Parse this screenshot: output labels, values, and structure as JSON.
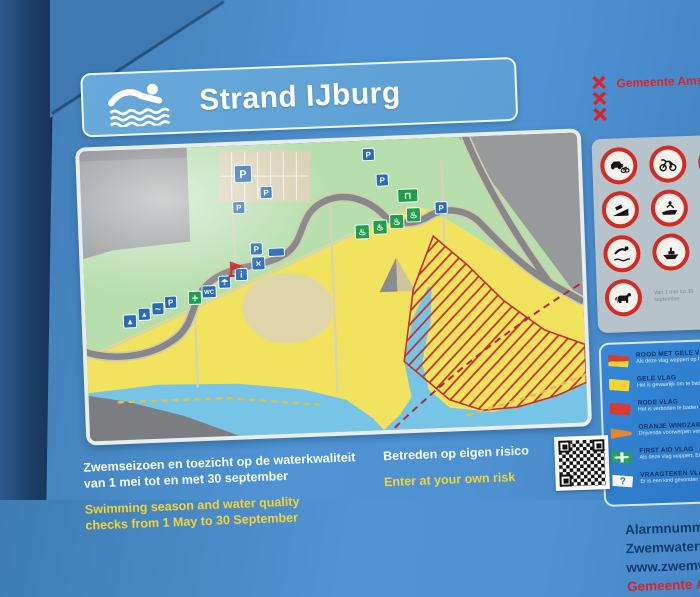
{
  "sign": {
    "title": "Strand IJburg"
  },
  "map": {
    "colors": {
      "park": "#b7dfae",
      "sand": "#f1e35e",
      "water": "#76c5e6",
      "road": "#85878b",
      "map_bg": "#97999a",
      "icon_blue": "#2b6cb8",
      "icon_green": "#1f9e4b",
      "hatch_red": "#c53030",
      "marker_red": "#cc2222"
    },
    "icons": [
      {
        "name": "parking",
        "glyph": "P",
        "x": 155,
        "y": 20,
        "w": 17,
        "h": 17,
        "fs": 11
      },
      {
        "name": "parking",
        "glyph": "P",
        "x": 284,
        "y": 8,
        "w": 12,
        "h": 12,
        "fs": 8
      },
      {
        "name": "parking",
        "glyph": "P",
        "x": 297,
        "y": 34,
        "w": 12,
        "h": 12,
        "fs": 8
      },
      {
        "name": "parking",
        "glyph": "P",
        "x": 180,
        "y": 42,
        "w": 12,
        "h": 12,
        "fs": 8
      },
      {
        "name": "parking",
        "glyph": "P",
        "x": 152,
        "y": 56,
        "w": 12,
        "h": 12,
        "fs": 8
      },
      {
        "name": "parking",
        "glyph": "P",
        "x": 168,
        "y": 98,
        "w": 12,
        "h": 12,
        "fs": 8
      },
      {
        "name": "parking",
        "glyph": "P",
        "x": 355,
        "y": 64,
        "w": 12,
        "h": 12,
        "fs": 8
      },
      {
        "name": "parking",
        "glyph": "P",
        "x": 80,
        "y": 148,
        "w": 12,
        "h": 12,
        "fs": 8
      },
      {
        "name": "wc",
        "glyph": "WC",
        "x": 118,
        "y": 139,
        "w": 14,
        "h": 12,
        "fs": 6
      },
      {
        "name": "shower",
        "glyph": "☂",
        "x": 135,
        "y": 130,
        "w": 12,
        "h": 12,
        "fs": 8
      },
      {
        "name": "info",
        "glyph": "i",
        "x": 152,
        "y": 123,
        "w": 12,
        "h": 12,
        "fs": 9
      },
      {
        "name": "restaurant",
        "glyph": "×",
        "x": 169,
        "y": 112,
        "w": 13,
        "h": 13,
        "fs": 10
      },
      {
        "name": "pavilion-label",
        "glyph": "",
        "x": 186,
        "y": 104,
        "w": 16,
        "h": 8,
        "fs": 4
      },
      {
        "name": "sailing",
        "glyph": "▲",
        "x": 38,
        "y": 165,
        "w": 13,
        "h": 13,
        "fs": 8
      },
      {
        "name": "windsurfing",
        "glyph": "▲",
        "x": 53,
        "y": 159,
        "w": 12,
        "h": 12,
        "fs": 7
      },
      {
        "name": "canoeing",
        "glyph": "~",
        "x": 67,
        "y": 154,
        "w": 12,
        "h": 12,
        "fs": 10
      },
      {
        "name": "first-aid",
        "glyph": "+",
        "x": 104,
        "y": 144,
        "w": 13,
        "h": 13,
        "fs": 11,
        "color": "#1f9e4b"
      },
      {
        "name": "bbq",
        "glyph": "♨",
        "x": 274,
        "y": 84,
        "w": 14,
        "h": 14,
        "fs": 9,
        "color": "#1f9e4b"
      },
      {
        "name": "bbq",
        "glyph": "♨",
        "x": 292,
        "y": 80,
        "w": 14,
        "h": 14,
        "fs": 9,
        "color": "#1f9e4b"
      },
      {
        "name": "bbq",
        "glyph": "♨",
        "x": 309,
        "y": 75,
        "w": 14,
        "h": 14,
        "fs": 9,
        "color": "#1f9e4b"
      },
      {
        "name": "bbq",
        "glyph": "♨",
        "x": 326,
        "y": 69,
        "w": 14,
        "h": 14,
        "fs": 9,
        "color": "#1f9e4b"
      },
      {
        "name": "picnic",
        "glyph": "⊓",
        "x": 318,
        "y": 50,
        "w": 20,
        "h": 13,
        "fs": 9,
        "color": "#1f9e4b"
      },
      {
        "name": "lifeguard-flag",
        "shape": "flag",
        "x": 148,
        "y": 130,
        "color": "#cc2222"
      }
    ]
  },
  "right_panel": {
    "municipality": "Gemeente Amsterdam",
    "prohibition_rows": [
      [
        "no-motor-vehicles",
        "no-mopeds",
        "no-open-fire"
      ],
      [
        "no-boat-launching",
        "no-jetski"
      ],
      [
        "no-diving",
        "no-motorboats"
      ],
      [
        "no-dogs"
      ]
    ],
    "prohibition_note": "Van 1 mei tot 30 september",
    "flags": [
      {
        "type": "red-yellow",
        "title": "ROOD MET GELE VLAG",
        "desc": "Als deze vlag wappert op het strand zijn er lifeguards aanwezig"
      },
      {
        "type": "yellow",
        "title": "GELE VLAG",
        "desc": "Het is gevaarlijk om te baden"
      },
      {
        "type": "red",
        "title": "RODE VLAG",
        "desc": "Het is verboden te baden"
      },
      {
        "type": "windsock",
        "title": "ORANJE WINDZAK",
        "desc": "Drijvende voorwerpen verboden"
      },
      {
        "type": "first-aid",
        "title": "FIRST AID VLAG",
        "desc": "Als deze vlag wappert, Eerste hulp verleners aanwezig"
      },
      {
        "type": "question",
        "glyph": "?",
        "title": "VRAAGTEKEN VLAG",
        "desc": "Er is een kind gevonden"
      }
    ]
  },
  "contact": {
    "lines": [
      "Alarmnummer:",
      "Zwemwatertelefoon:",
      "www.zwemwater.nl"
    ],
    "municipality": "Gemeente Amsterdam"
  },
  "footer": {
    "left_nl": [
      "Zwemseizoen en toezicht op de waterkwaliteit",
      "van 1 mei tot en met 30 september"
    ],
    "left_en": [
      "Swimming season and water quality",
      "checks from 1 May to 30 September"
    ],
    "right_nl": [
      "Betreden op eigen risico"
    ],
    "right_en": [
      "Enter at your own risk"
    ]
  }
}
